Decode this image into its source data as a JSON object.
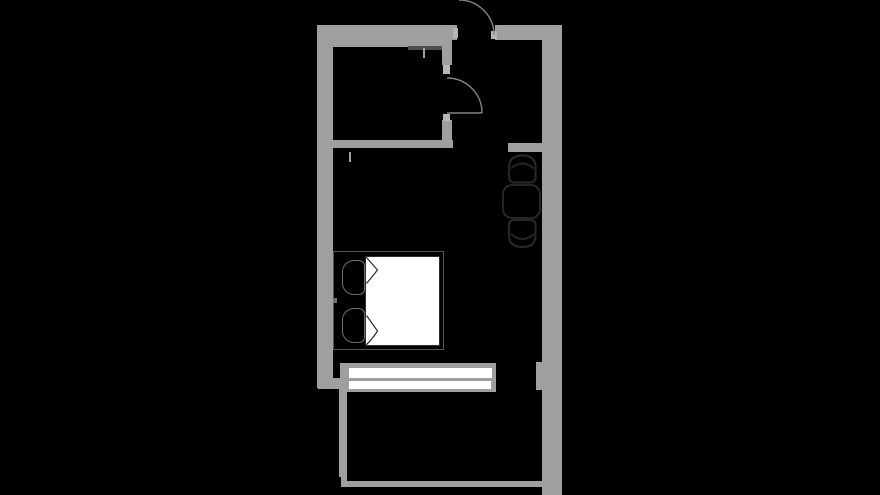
{
  "meta": {
    "type": "floorplan",
    "description": "black-background apartment floor plan: bathroom top-left, entry with two swing doors, dining table with two chairs at right wall, double bed with two pillows, window wall at bottom, balcony below"
  },
  "canvas": {
    "width": 880,
    "height": 495,
    "background": "#000000"
  },
  "colors": {
    "bg": "#000000",
    "black": "#000000",
    "wall": "#9f9f9f",
    "jamb": "#b7b7b7",
    "white": "#ffffff",
    "arc": "#828282",
    "dark": "#262626",
    "pillow": "#6f6f6f",
    "frame": "#565656",
    "blanket_edge": "#2e2e2e",
    "shower": "#4e4e4e"
  },
  "layers": {
    "rects": [
      {
        "name": "wall-top-bathroom",
        "x": 317,
        "y": 25,
        "w": 131,
        "h": 22,
        "fill": "wall"
      },
      {
        "name": "wall-top-entry",
        "x": 448,
        "y": 25,
        "w": 9,
        "h": 15,
        "fill": "wall"
      },
      {
        "name": "wall-top-right",
        "x": 495,
        "y": 25,
        "w": 67,
        "h": 15,
        "fill": "wall"
      },
      {
        "name": "wall-left",
        "x": 317,
        "y": 25,
        "w": 16,
        "h": 363,
        "fill": "wall"
      },
      {
        "name": "wall-right",
        "x": 542,
        "y": 25,
        "w": 20,
        "h": 470,
        "fill": "wall"
      },
      {
        "name": "wall-bathroom-partition-upper",
        "x": 442,
        "y": 40,
        "w": 10,
        "h": 25,
        "fill": "wall"
      },
      {
        "name": "wall-bathroom-partition-lower",
        "x": 442,
        "y": 120,
        "w": 10,
        "h": 28,
        "fill": "wall"
      },
      {
        "name": "wall-bathroom-south",
        "x": 328,
        "y": 140,
        "w": 125,
        "h": 8,
        "fill": "wall"
      },
      {
        "name": "wall-entry-stub",
        "x": 508,
        "y": 143,
        "w": 34,
        "h": 9,
        "fill": "wall"
      },
      {
        "name": "jamb-entry-door-left",
        "x": 453,
        "y": 28,
        "w": 5,
        "h": 10,
        "fill": "jamb"
      },
      {
        "name": "jamb-entry-door-right",
        "x": 491,
        "y": 31,
        "w": 6,
        "h": 8,
        "fill": "jamb"
      },
      {
        "name": "jamb-bathroom-door-top",
        "x": 443,
        "y": 65,
        "w": 7,
        "h": 9,
        "fill": "jamb"
      },
      {
        "name": "jamb-bathroom-door-bottom",
        "x": 443,
        "y": 114,
        "w": 7,
        "h": 7,
        "fill": "jamb"
      },
      {
        "name": "shower-screen-line",
        "x": 408,
        "y": 46,
        "w": 34,
        "h": 4,
        "fill": "shower"
      },
      {
        "name": "shower-screen-tick",
        "x": 423,
        "y": 48,
        "w": 2,
        "h": 10,
        "fill": "wall"
      },
      {
        "name": "wall-end-tick",
        "x": 349,
        "y": 152,
        "w": 2,
        "h": 10,
        "fill": "wall"
      },
      {
        "name": "window-frame",
        "x": 340,
        "y": 363,
        "w": 156,
        "h": 29,
        "fill": "wall"
      },
      {
        "name": "window-pane-upper",
        "x": 349,
        "y": 368,
        "w": 143,
        "h": 10,
        "fill": "white"
      },
      {
        "name": "window-pane-lower",
        "x": 349,
        "y": 381,
        "w": 142,
        "h": 8,
        "fill": "white"
      },
      {
        "name": "wall-window-pier",
        "x": 536,
        "y": 362,
        "w": 24,
        "h": 28,
        "fill": "wall"
      },
      {
        "name": "wall-bottom-left-step",
        "x": 318,
        "y": 378,
        "w": 24,
        "h": 11,
        "fill": "wall"
      },
      {
        "name": "wall-balcony-left",
        "x": 339,
        "y": 388,
        "w": 8,
        "h": 89,
        "fill": "wall"
      },
      {
        "name": "wall-balcony-left-stub",
        "x": 341,
        "y": 477,
        "w": 6,
        "h": 10,
        "fill": "wall"
      },
      {
        "name": "wall-balcony-bottom",
        "x": 342,
        "y": 481,
        "w": 207,
        "h": 6,
        "fill": "wall"
      },
      {
        "name": "bed-frame",
        "x": 333,
        "y": 251,
        "w": 111,
        "h": 99,
        "fill": "black",
        "border": "1.5 frame"
      },
      {
        "name": "bed-blanket",
        "x": 365,
        "y": 256,
        "w": 75,
        "h": 90,
        "fill": "white",
        "border": "1.5 blanket_edge"
      },
      {
        "name": "pillow-top",
        "x": 342,
        "y": 260,
        "w": 23,
        "h": 35,
        "fill": "black",
        "border": "1.4 pillow",
        "radius": "12px 6px 6px 12px"
      },
      {
        "name": "pillow-bottom",
        "x": 342,
        "y": 308,
        "w": 23,
        "h": 35,
        "fill": "black",
        "border": "1.4 pillow",
        "radius": "12px 6px 6px 12px"
      },
      {
        "name": "bed-edge-tick",
        "x": 333,
        "y": 298,
        "w": 4,
        "h": 5,
        "fill": "pillow"
      },
      {
        "name": "dining-table",
        "x": 502,
        "y": 184,
        "w": 39,
        "h": 35,
        "fill": "black",
        "border": "2.4 dark",
        "radius": "10px"
      }
    ],
    "paths": [
      {
        "name": "entry-door-swing-arc",
        "d": "M 459 0 A 35 35 0 0 1 494 35",
        "stroke": "arc",
        "w": 1.4,
        "fill": "none"
      },
      {
        "name": "bathroom-door-swing-arc",
        "d": "M 447 78 A 35 35 0 0 1 482 113",
        "stroke": "arc",
        "w": 1.4,
        "fill": "none"
      },
      {
        "name": "bathroom-door-leaf",
        "d": "M 447 113 L 482 113",
        "stroke": "arc",
        "w": 1.4,
        "fill": "none"
      },
      {
        "name": "blanket-fold-top",
        "d": "M 366 257 L 377.5 270 Q 372 277 366.5 283.5",
        "stroke": "blanket_edge",
        "w": 1.2,
        "fill": "white"
      },
      {
        "name": "blanket-fold-bottom",
        "d": "M 366.5 315.5 L 377.5 331 Q 372.5 339 366 345",
        "stroke": "blanket_edge",
        "w": 1.2,
        "fill": "white"
      },
      {
        "name": "chair-top-seat",
        "d": "M 509 177 L 509 167 Q 509 155.5 522.5 155.5 Q 535.5 155.5 535.5 167 L 535.5 177 Q 535.5 182.5 530 182.5 L 514.5 182.5 Q 509 182.5 509 177 Z",
        "stroke": "dark",
        "w": 2.2,
        "fill": "black"
      },
      {
        "name": "chair-top-back",
        "d": "M 511 168.5 Q 522.5 158.5 534 168.5",
        "stroke": "dark",
        "w": 2,
        "fill": "none"
      },
      {
        "name": "chair-bottom-seat",
        "d": "M 509 225.5 Q 509 220 514.5 220 L 530 220 Q 535.5 220 535.5 225.5 L 535.5 235.5 Q 535.5 247 522.5 247 Q 509 247 509 235.5 Z",
        "stroke": "dark",
        "w": 2.2,
        "fill": "black"
      },
      {
        "name": "chair-bottom-back",
        "d": "M 511 234 Q 522.5 244 534 234",
        "stroke": "dark",
        "w": 2,
        "fill": "none"
      }
    ]
  }
}
